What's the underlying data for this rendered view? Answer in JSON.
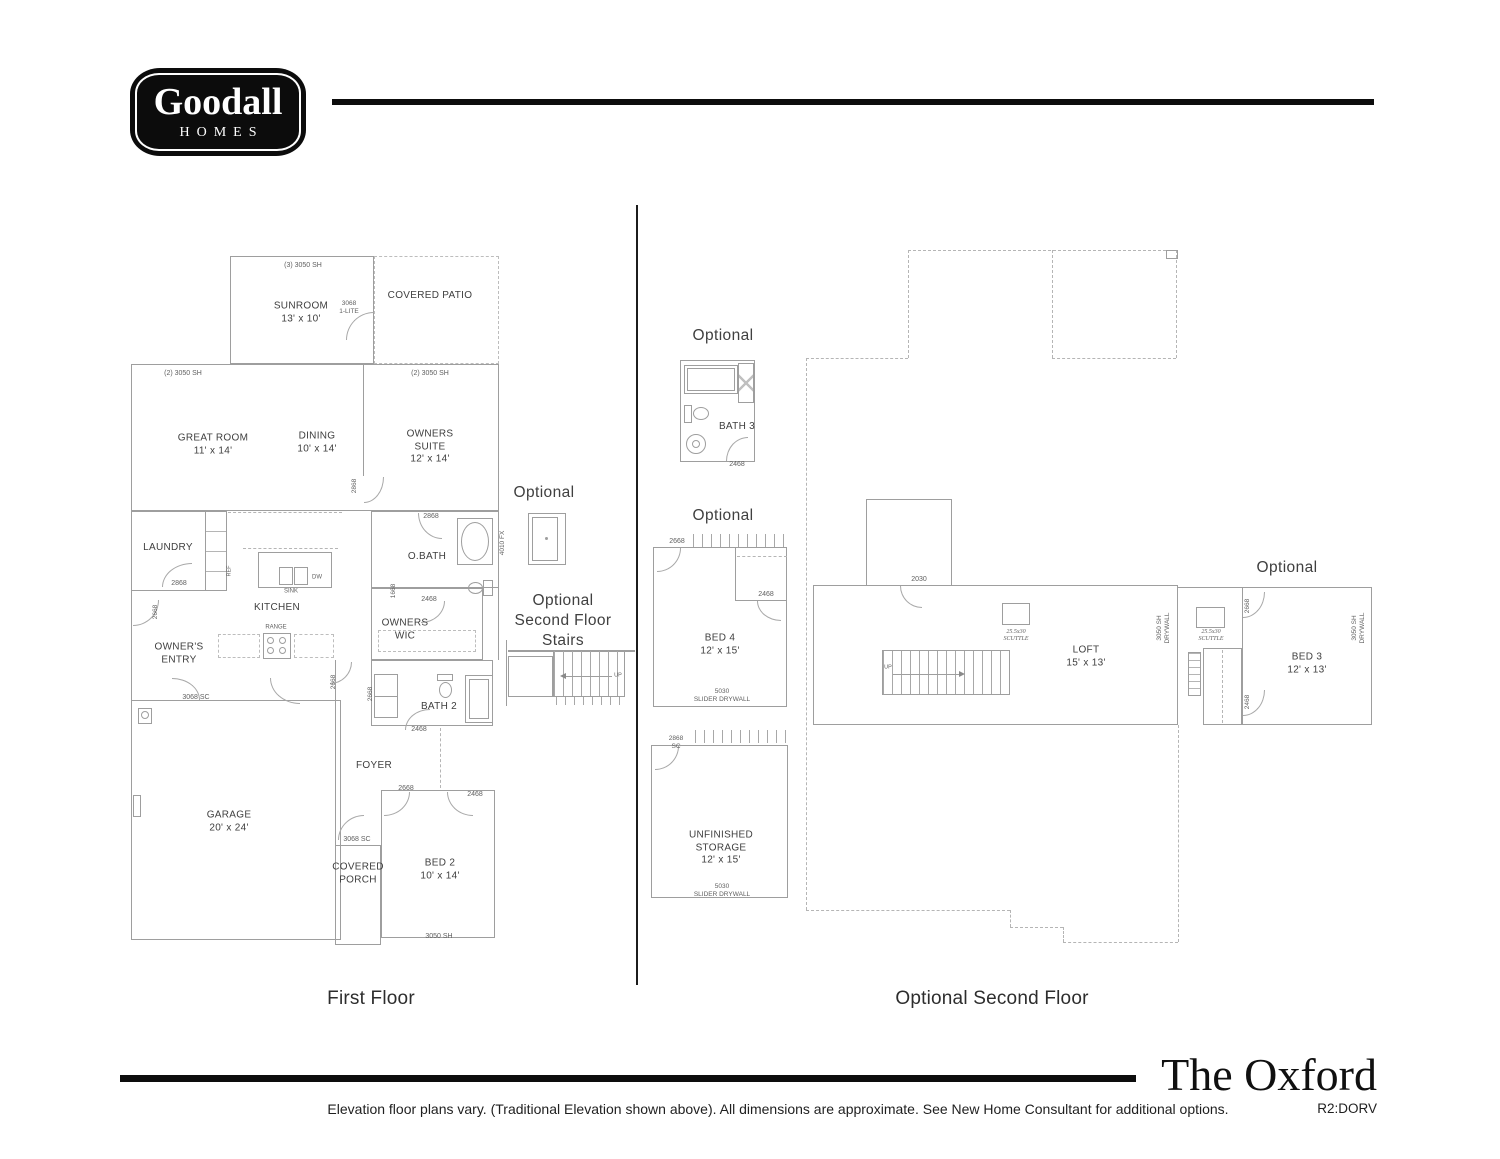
{
  "page": {
    "brand": {
      "name": "Goodall",
      "sub": "HOMES"
    },
    "title": "The Oxford",
    "revision": "R2:DORV",
    "disclaimer": "Elevation floor plans vary. (Traditional Elevation shown above). All dimensions are approximate. See New Home Consultant for additional options.",
    "captions": {
      "first": "First Floor",
      "second": "Optional Second Floor"
    },
    "optional": "Optional",
    "stairs_note": {
      "l1": "Optional",
      "l2": "Second Floor",
      "l3": "Stairs"
    }
  },
  "ff": {
    "sunroom": {
      "name": "SUNROOM",
      "dims": "13' x 10'"
    },
    "patio": {
      "name": "COVERED PATIO"
    },
    "great": {
      "name": "GREAT ROOM",
      "dims": "11' x 14'"
    },
    "dining": {
      "name": "DINING",
      "dims": "10' x 14'"
    },
    "suite": {
      "l1": "OWNERS",
      "l2": "SUITE",
      "dims": "12' x 14'"
    },
    "laundry": {
      "name": "LAUNDRY"
    },
    "kitchen": {
      "name": "KITCHEN"
    },
    "obath": {
      "name": "O.BATH"
    },
    "wic": {
      "l1": "OWNERS",
      "l2": "WIC"
    },
    "entry": {
      "l1": "OWNER'S",
      "l2": "ENTRY"
    },
    "bath2": {
      "name": "BATH 2"
    },
    "foyer": {
      "name": "FOYER"
    },
    "garage": {
      "name": "GARAGE",
      "dims": "20' x 24'"
    },
    "porch": {
      "l1": "COVERED",
      "l2": "PORCH"
    },
    "bed2": {
      "name": "BED 2",
      "dims": "10' x 14'"
    }
  },
  "sf": {
    "bath3": {
      "name": "BATH 3"
    },
    "bed4": {
      "name": "BED 4",
      "dims": "12' x 15'"
    },
    "storage": {
      "l1": "UNFINISHED",
      "l2": "STORAGE",
      "dims": "12' x 15'"
    },
    "loft": {
      "name": "LOFT",
      "dims": "15' x 13'"
    },
    "bed3": {
      "name": "BED 3",
      "dims": "12' x 13'"
    }
  },
  "ann": {
    "w3050x3": "(3) 3050 SH",
    "w3050x2": "(2) 3050 SH",
    "lite1": "3068",
    "lite2": "1-LITE",
    "d2868": "2868",
    "d2668": "2668",
    "d2468": "2468",
    "d1668": "1668",
    "d3068sc": "3068 SC",
    "d2030": "2030",
    "sc": "SC",
    "w4010fx": "4010 FX",
    "w3050sh": "3050 SH",
    "ref": "REF",
    "sink": "SINK",
    "dw": "DW",
    "range": "RANGE",
    "up": "UP",
    "slider1": "5030",
    "slider2": "SLIDER DRYWALL",
    "scuttle1": "25.5x30",
    "scuttle2": "SCUTTLE",
    "dry1": "3050 SH",
    "dry2": "DRYWALL"
  }
}
